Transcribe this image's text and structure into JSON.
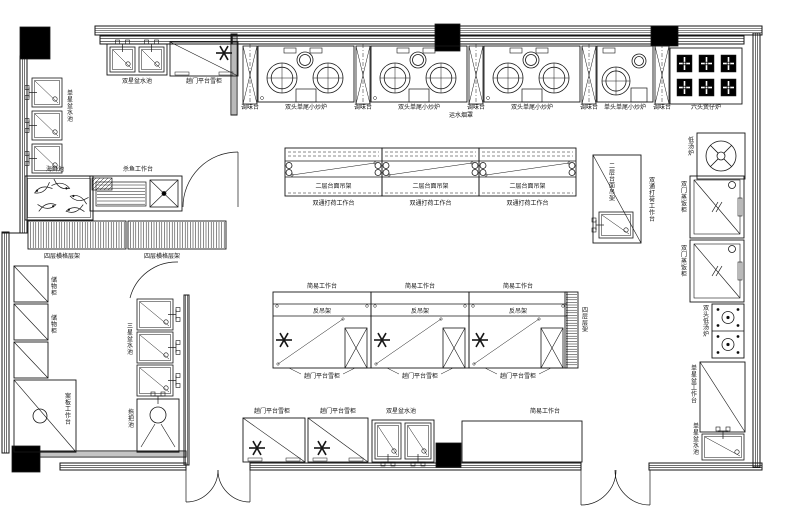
{
  "document": {
    "type": "kitchen-floor-plan",
    "language": "zh"
  },
  "canvas": {
    "w": 785,
    "h": 513,
    "bg": "#ffffff",
    "ink": "#161616"
  },
  "items": [
    {
      "t": "band",
      "name": "top-wall",
      "x": 95,
      "y": 26,
      "w": 667,
      "h": 9,
      "n": 3
    },
    {
      "t": "band",
      "name": "exhaust-hood-band",
      "x": 232,
      "y": 36,
      "w": 512,
      "h": 8,
      "n": 2
    },
    {
      "t": "band",
      "name": "topleft-room-wall",
      "x": 100,
      "y": 36,
      "w": 132,
      "h": 8,
      "n": 2
    },
    {
      "t": "band",
      "name": "left-wall-upper",
      "x": 20,
      "y": 56,
      "w": 7,
      "h": 177,
      "vert": 1,
      "n": 2
    },
    {
      "t": "band",
      "name": "left-wall-lower",
      "x": 2,
      "y": 232,
      "w": 7,
      "h": 221,
      "vert": 1,
      "n": 2
    },
    {
      "t": "line",
      "name": "left-wall-step",
      "x1": 2,
      "y1": 233,
      "x2": 27,
      "y2": 233
    },
    {
      "t": "band",
      "name": "right-wall",
      "x": 753,
      "y": 33,
      "w": 7,
      "h": 434,
      "vert": 1,
      "n": 2
    },
    {
      "t": "band",
      "name": "bottom-wall-left",
      "x": 60,
      "y": 463,
      "w": 126,
      "h": 7,
      "n": 2
    },
    {
      "t": "band",
      "name": "bottom-wall-center",
      "x": 250,
      "y": 463,
      "w": 331,
      "h": 7,
      "n": 2
    },
    {
      "t": "band",
      "name": "bottom-wall-right",
      "x": 649,
      "y": 463,
      "w": 113,
      "h": 7,
      "n": 2
    },
    {
      "t": "band",
      "name": "prep-room-bottom-wall",
      "x": 38,
      "y": 451,
      "w": 148,
      "h": 6,
      "n": 2
    },
    {
      "t": "band",
      "name": "partition-upper",
      "x": 231,
      "y": 34,
      "w": 6,
      "h": 81,
      "vert": 1,
      "n": 2
    },
    {
      "t": "band",
      "name": "partition-left-room",
      "x": 184,
      "y": 295,
      "w": 5,
      "h": 170,
      "vert": 1,
      "n": 2
    },
    {
      "t": "column",
      "name": "column-1",
      "x": 20,
      "y": 27,
      "w": 30,
      "h": 32
    },
    {
      "t": "column",
      "name": "column-2",
      "x": 435,
      "y": 24,
      "w": 25,
      "h": 27
    },
    {
      "t": "column",
      "name": "column-3",
      "x": 651,
      "y": 26,
      "w": 27,
      "h": 20
    },
    {
      "t": "column",
      "name": "column-4",
      "x": 436,
      "y": 443,
      "w": 25,
      "h": 24
    },
    {
      "t": "column",
      "name": "column-5",
      "x": 12,
      "y": 446,
      "w": 28,
      "h": 26
    },
    {
      "t": "door",
      "name": "interior-door-upper",
      "paths": [
        "M 183,207 A 55 55 0 0 1 238,152",
        "M 238,152 L 238,207"
      ]
    },
    {
      "t": "door",
      "name": "interior-door-left",
      "paths": [
        "M 130,298 A 48 48 0 0 1 178,262"
      ]
    },
    {
      "t": "door",
      "name": "double-door-left",
      "paths": [
        "M 186,470 L 186,502",
        "M 218,470 A 32 32 0 0 1 186,502",
        "M 250,470 L 250,502",
        "M 218,470 A 32 32 0 0 0 250,502"
      ]
    },
    {
      "t": "door",
      "name": "double-door-right",
      "paths": [
        "M 581,470 L 581,505",
        "M 616,470 A 35 35 0 0 1 581,505",
        "M 650,470 L 650,505",
        "M 615,470 A 35 35 0 0 0 650,505"
      ]
    },
    {
      "t": "dsink",
      "name": "double-basin-sink-top",
      "x": 107,
      "y": 44,
      "w": 60,
      "h": 31,
      "tap": "top",
      "label": {
        "text": "双星盆水池",
        "x": 137,
        "y": 83
      }
    },
    {
      "t": "fridge",
      "name": "platform-fridge-top",
      "x": 170,
      "y": 42,
      "w": 68,
      "h": 34,
      "sx": 224,
      "sy": 53,
      "label": {
        "text": "趟门平台雪柜",
        "x": 204,
        "y": 83
      }
    },
    {
      "t": "sink",
      "name": "single-basin-sink-1",
      "x": 32,
      "y": 78,
      "w": 30,
      "h": 29,
      "tap": "left"
    },
    {
      "t": "sink",
      "name": "single-basin-sink-2",
      "x": 32,
      "y": 111,
      "w": 30,
      "h": 29,
      "tap": "left"
    },
    {
      "t": "sink",
      "name": "single-basin-sink-3",
      "x": 32,
      "y": 144,
      "w": 30,
      "h": 29,
      "tap": "left"
    },
    {
      "t": "label",
      "name": "single-sink-label",
      "x": 70,
      "y": 95,
      "text": "单星盆水池",
      "vert": 1
    },
    {
      "t": "fishtank",
      "name": "seafood-tank",
      "x": 25,
      "y": 176,
      "w": 68,
      "h": 44,
      "label": {
        "text": "海鲜池",
        "x": 55,
        "y": 171
      }
    },
    {
      "t": "rect",
      "name": "fish-prep-table",
      "x": 90,
      "y": 176,
      "w": 92,
      "h": 35,
      "label": {
        "text": "杀鱼工作台",
        "x": 138,
        "y": 171
      }
    },
    {
      "t": "hatch",
      "name": "fish-prep-hatch",
      "x": 92,
      "y": 178,
      "w": 20,
      "h": 12
    },
    {
      "t": "slats",
      "name": "fish-prep-drainer",
      "x": 96,
      "y": 182,
      "w": 50,
      "h": 24
    },
    {
      "t": "xbox",
      "name": "fish-prep-sink",
      "x": 150,
      "y": 180,
      "w": 28,
      "h": 27,
      "dot": 1
    },
    {
      "t": "vstripes",
      "name": "four-tier-rack-1",
      "x": 28,
      "y": 221,
      "w": 98,
      "h": 28,
      "label": {
        "text": "四层横格层架",
        "x": 62,
        "y": 258
      }
    },
    {
      "t": "vstripes",
      "name": "four-tier-rack-2",
      "x": 128,
      "y": 221,
      "w": 98,
      "h": 28,
      "label": {
        "text": "四层横格层架",
        "x": 162,
        "y": 258
      }
    },
    {
      "t": "rect",
      "name": "storage-cabinet-1",
      "x": 14,
      "y": 266,
      "w": 34,
      "h": 36,
      "diag": 1
    },
    {
      "t": "rect",
      "name": "storage-cabinet-2",
      "x": 14,
      "y": 304,
      "w": 34,
      "h": 36,
      "diag": 1
    },
    {
      "t": "rect",
      "name": "storage-cabinet-3",
      "x": 14,
      "y": 342,
      "w": 34,
      "h": 36,
      "diag": 1
    },
    {
      "t": "label",
      "name": "storage-cabinet-label-1",
      "x": 54,
      "y": 282,
      "text": "储物柜",
      "vert": 1
    },
    {
      "t": "label",
      "name": "storage-cabinet-label-2",
      "x": 54,
      "y": 320,
      "text": "储物柜",
      "vert": 1
    },
    {
      "t": "rect",
      "name": "chopping-table",
      "x": 14,
      "y": 380,
      "w": 62,
      "h": 72,
      "diag": 1,
      "circle": [
        40,
        416,
        7
      ]
    },
    {
      "t": "label",
      "name": "chopping-table-label",
      "x": 68,
      "y": 398,
      "text": "案板工作台",
      "vert": 1
    },
    {
      "t": "sink",
      "name": "triple-basin-sink-1",
      "x": 137,
      "y": 299,
      "w": 36,
      "h": 31,
      "tap": "right"
    },
    {
      "t": "sink",
      "name": "triple-basin-sink-2",
      "x": 137,
      "y": 332,
      "w": 36,
      "h": 31,
      "tap": "right"
    },
    {
      "t": "sink",
      "name": "triple-basin-sink-3",
      "x": 137,
      "y": 365,
      "w": 36,
      "h": 31,
      "tap": "right"
    },
    {
      "t": "label",
      "name": "triple-sink-label",
      "x": 130,
      "y": 328,
      "text": "三星盆水池",
      "vert": 1
    },
    {
      "t": "mop",
      "name": "mop-sink",
      "x": 137,
      "y": 399,
      "w": 42,
      "h": 53
    },
    {
      "t": "label",
      "name": "mop-sink-label",
      "x": 131,
      "y": 414,
      "text": "拖把池",
      "vert": 1
    },
    {
      "t": "xunit",
      "name": "condiment-stand-1",
      "x": 243,
      "y": 46,
      "w": 14,
      "h": 58,
      "label": {
        "text": "调味台",
        "x": 250,
        "y": 109
      }
    },
    {
      "t": "xunit",
      "name": "condiment-stand-2",
      "x": 356,
      "y": 46,
      "w": 14,
      "h": 58,
      "label": {
        "text": "调味台",
        "x": 363,
        "y": 109
      }
    },
    {
      "t": "xunit",
      "name": "condiment-stand-3",
      "x": 469,
      "y": 46,
      "w": 14,
      "h": 58,
      "label": {
        "text": "调味台",
        "x": 476,
        "y": 109
      }
    },
    {
      "t": "xunit",
      "name": "condiment-stand-4",
      "x": 582,
      "y": 46,
      "w": 14,
      "h": 58,
      "label": {
        "text": "调味台",
        "x": 589,
        "y": 109
      }
    },
    {
      "t": "xunit",
      "name": "condiment-stand-5",
      "x": 655,
      "y": 46,
      "w": 14,
      "h": 58,
      "label": {
        "text": "调味台",
        "x": 662,
        "y": 109
      }
    },
    {
      "t": "wok2",
      "name": "double-wok-stove-1",
      "x": 258,
      "y": 46,
      "w": 96,
      "h": 56,
      "label": {
        "text": "双头单尾小炒炉",
        "x": 306,
        "y": 109
      }
    },
    {
      "t": "wok2",
      "name": "double-wok-stove-2",
      "x": 371,
      "y": 46,
      "w": 96,
      "h": 56,
      "label": {
        "text": "双头单尾小炒炉",
        "x": 419,
        "y": 109
      }
    },
    {
      "t": "wok2",
      "name": "double-wok-stove-3",
      "x": 484,
      "y": 46,
      "w": 96,
      "h": 56,
      "label": {
        "text": "双头单尾小炒炉",
        "x": 532,
        "y": 109
      }
    },
    {
      "t": "label",
      "name": "hood-note",
      "x": 461,
      "y": 117,
      "text": "运水烟罩"
    },
    {
      "t": "wok1",
      "name": "single-wok-stove",
      "x": 597,
      "y": 46,
      "w": 56,
      "h": 56,
      "label": {
        "text": "单头单尾小炒炉",
        "x": 625,
        "y": 109
      }
    },
    {
      "t": "burner6",
      "name": "six-burner-stove",
      "x": 670,
      "y": 48,
      "w": 72,
      "h": 56,
      "label": {
        "text": "六头煲仔炉",
        "x": 706,
        "y": 109
      }
    },
    {
      "t": "uisland",
      "name": "prep-island-1",
      "x": 285,
      "y": 148,
      "w": 97,
      "h": 48,
      "label1": "二层台面吊架",
      "label2": "双通打荷工作台"
    },
    {
      "t": "uisland",
      "name": "prep-island-2",
      "x": 382,
      "y": 148,
      "w": 97,
      "h": 48,
      "label1": "二层台面吊架",
      "label2": "双通打荷工作台"
    },
    {
      "t": "uisland",
      "name": "prep-island-3",
      "x": 479,
      "y": 148,
      "w": 97,
      "h": 48,
      "label1": "二层台面吊架",
      "label2": "双通打荷工作台"
    },
    {
      "t": "rect",
      "name": "corner-prep-table",
      "x": 593,
      "y": 155,
      "w": 48,
      "h": 88,
      "diag": 1
    },
    {
      "t": "sink",
      "name": "corner-prep-sink",
      "x": 599,
      "y": 212,
      "w": 34,
      "h": 26,
      "tap": "left"
    },
    {
      "t": "label",
      "name": "corner-shelf-label",
      "x": 612,
      "y": 168,
      "text": "二层台面吊架",
      "vert": 1
    },
    {
      "t": "label",
      "name": "corner-table-label",
      "x": 652,
      "y": 182,
      "text": "双通打荷工作台",
      "vert": 1
    },
    {
      "t": "lisland",
      "name": "island-unit-1",
      "x": 273,
      "y": 292,
      "w": 98,
      "h": 76,
      "top": "简易工作台",
      "mid": "反吊架",
      "bottom": "趟门平台雪柜"
    },
    {
      "t": "lisland",
      "name": "island-unit-2",
      "x": 371,
      "y": 292,
      "w": 98,
      "h": 76,
      "top": "简易工作台",
      "mid": "反吊架",
      "bottom": "趟门平台雪柜"
    },
    {
      "t": "lisland",
      "name": "island-unit-3",
      "x": 469,
      "y": 292,
      "w": 98,
      "h": 76,
      "top": "简易工作台",
      "mid": "反吊架",
      "bottom": "趟门平台雪柜"
    },
    {
      "t": "hstripes",
      "name": "tier-rack-strip",
      "x": 565,
      "y": 292,
      "w": 13,
      "h": 76
    },
    {
      "t": "label",
      "name": "tier-rack-label",
      "x": 585,
      "y": 312,
      "text": "四层层架",
      "vert": 1
    },
    {
      "t": "fanstove",
      "name": "soup-stove",
      "x": 697,
      "y": 133,
      "w": 48,
      "h": 46
    },
    {
      "t": "label",
      "name": "soup-stove-label",
      "x": 691,
      "y": 142,
      "text": "低汤炉",
      "vert": 1
    },
    {
      "t": "steamer",
      "name": "rice-steamer-1",
      "x": 690,
      "y": 176,
      "w": 54,
      "h": 62
    },
    {
      "t": "label",
      "name": "rice-steamer-label-1",
      "x": 684,
      "y": 186,
      "text": "双门蒸饭柜",
      "vert": 1
    },
    {
      "t": "steamer",
      "name": "rice-steamer-2",
      "x": 690,
      "y": 240,
      "w": 54,
      "h": 62
    },
    {
      "t": "label",
      "name": "rice-steamer-label-2",
      "x": 684,
      "y": 250,
      "text": "双门蒸饭柜",
      "vert": 1
    },
    {
      "t": "lowpot",
      "name": "double-soup-stove",
      "x": 712,
      "y": 304,
      "w": 32,
      "h": 54
    },
    {
      "t": "label",
      "name": "double-soup-stove-label",
      "x": 706,
      "y": 310,
      "text": "双头低汤炉",
      "vert": 1
    },
    {
      "t": "rect",
      "name": "right-work-table",
      "x": 700,
      "y": 362,
      "w": 45,
      "h": 70,
      "diag": 1
    },
    {
      "t": "label",
      "name": "right-work-table-label",
      "x": 694,
      "y": 370,
      "text": "单星盆工作台",
      "vert": 1
    },
    {
      "t": "sink",
      "name": "corner-sink",
      "x": 702,
      "y": 434,
      "w": 42,
      "h": 26,
      "tap": "top"
    },
    {
      "t": "label",
      "name": "corner-sink-label",
      "x": 696,
      "y": 428,
      "text": "单星盆水池",
      "vert": 1
    },
    {
      "t": "fridge",
      "name": "counter-fridge-1",
      "x": 243,
      "y": 418,
      "w": 62,
      "h": 44,
      "sx": 257,
      "sy": 448,
      "label": {
        "text": "趟门平台雪柜",
        "x": 272,
        "y": 413
      }
    },
    {
      "t": "fridge",
      "name": "counter-fridge-2",
      "x": 308,
      "y": 418,
      "w": 60,
      "h": 44,
      "sx": 322,
      "sy": 448,
      "label": {
        "text": "趟门平台雪柜",
        "x": 338,
        "y": 413
      }
    },
    {
      "t": "dsink",
      "name": "double-basin-sink-bottom",
      "x": 372,
      "y": 420,
      "w": 62,
      "h": 42,
      "tap": "bottom",
      "label": {
        "text": "双星盆水池",
        "x": 401,
        "y": 413
      }
    },
    {
      "t": "rect",
      "name": "simple-work-table-bottom",
      "x": 462,
      "y": 421,
      "w": 120,
      "h": 41,
      "label": {
        "text": "简易工作台",
        "x": 545,
        "y": 413
      }
    }
  ]
}
